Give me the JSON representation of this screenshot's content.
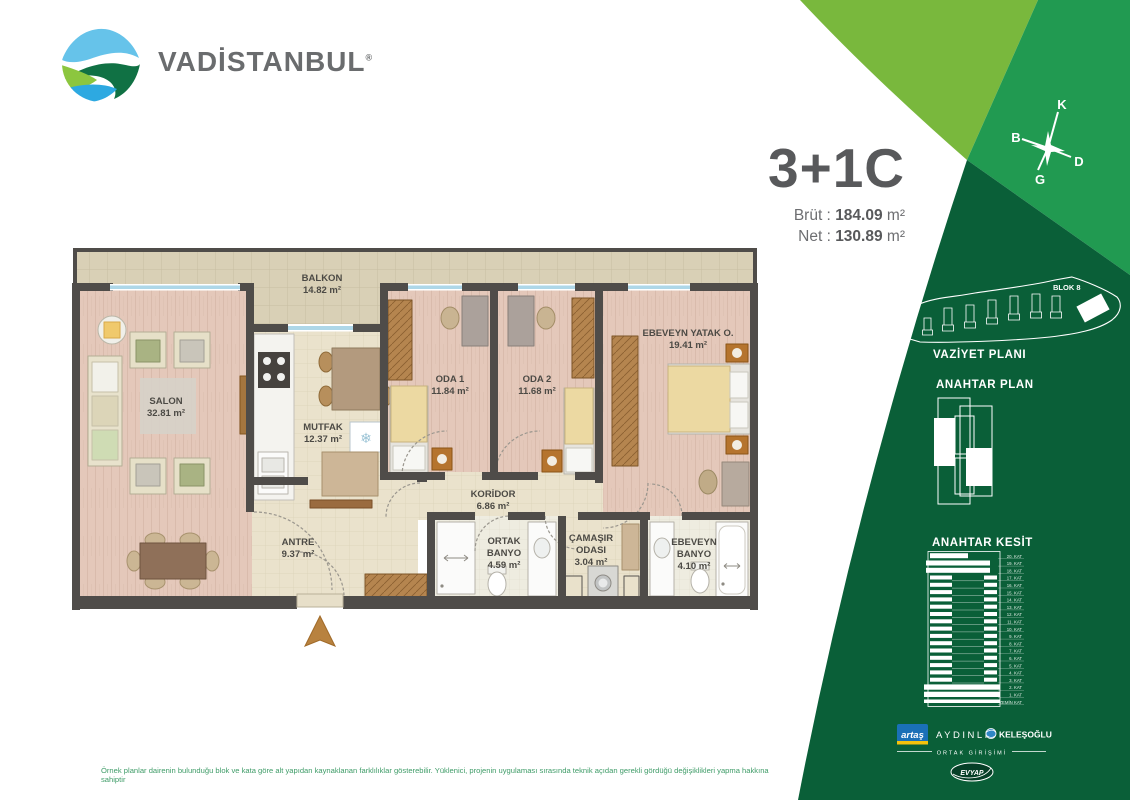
{
  "header": {
    "brand": "VADİSTANBUL",
    "registered": "®"
  },
  "unit_info": {
    "code": "3+1C",
    "brut_label": "Brüt :",
    "brut_value": "184.09",
    "brut_unit": "m²",
    "net_label": "Net :",
    "net_value": "130.89",
    "net_unit": "m²"
  },
  "compass": {
    "north": "K",
    "west": "B",
    "east": "D",
    "south": "G"
  },
  "sections": {
    "vaziyet_title": "VAZİYET PLANI",
    "blok_label": "BLOK 8",
    "plan_title": "ANAHTAR PLAN",
    "kesit_title": "ANAHTAR KESİT"
  },
  "kesit_floors": [
    "20. KAT",
    "19. KAT",
    "18. KAT",
    "17. KAT",
    "16. KAT",
    "15. KAT",
    "14. KAT",
    "13. KAT",
    "12. KAT",
    "11. KAT",
    "10. KAT",
    "9. KAT",
    "8. KAT",
    "7. KAT",
    "6. KAT",
    "5. KAT",
    "4. KAT",
    "3. KAT",
    "2. KAT",
    "1. KAT",
    "ZEMİN KAT"
  ],
  "plan": {
    "rooms": [
      {
        "lines": [
          "BALKON"
        ],
        "area": "14.82 m²",
        "x": 322,
        "y": 281
      },
      {
        "lines": [
          "SALON"
        ],
        "area": "32.81 m²",
        "x": 166,
        "y": 404
      },
      {
        "lines": [
          "MUTFAK"
        ],
        "area": "12.37 m²",
        "x": 323,
        "y": 430
      },
      {
        "lines": [
          "ODA 1"
        ],
        "area": "11.84 m²",
        "x": 450,
        "y": 382
      },
      {
        "lines": [
          "ODA 2"
        ],
        "area": "11.68 m²",
        "x": 537,
        "y": 382
      },
      {
        "lines": [
          "EBEVEYN YATAK O."
        ],
        "area": "19.41 m²",
        "x": 688,
        "y": 336
      },
      {
        "lines": [
          "KORİDOR"
        ],
        "area": "6.86 m²",
        "x": 493,
        "y": 497
      },
      {
        "lines": [
          "ANTRE"
        ],
        "area": "9.37 m²",
        "x": 298,
        "y": 545
      },
      {
        "lines": [
          "ORTAK",
          "BANYO"
        ],
        "area": "4.59 m²",
        "x": 504,
        "y": 544
      },
      {
        "lines": [
          "ÇAMAŞIR",
          "ODASI"
        ],
        "area": "3.04 m²",
        "x": 591,
        "y": 541
      },
      {
        "lines": [
          "EBEVEYN",
          "BANYO"
        ],
        "area": "4.10 m²",
        "x": 694,
        "y": 545
      }
    ]
  },
  "partners": {
    "artas": "artaş",
    "aydinli": "AYDINLI",
    "kelesoglu": "KELEŞOĞLU",
    "joint_label": "ORTAK GİRİŞİMİ",
    "evyap": "EVYAP"
  },
  "footer": {
    "disclaimer": "Örnek planlar dairenin bulunduğu blok ve kata göre alt yapıdan kaynaklanan farklılıklar gösterebilir. Yüklenici, projenin uygulaması sırasında teknik açıdan gerekli gördüğü değişiklikleri yapma hakkına sahiptir"
  },
  "colors": {
    "green_light": "#79b83d",
    "green_mid": "#219a51",
    "green_dark": "#0a5f38",
    "title_gray": "#58595b",
    "wall": "#4f4c49",
    "window_blue": "#aed7e8",
    "disclaimer_green": "#3f9c68",
    "artas_blue": "#1a70b7",
    "artas_yellow": "#f4c20c"
  }
}
